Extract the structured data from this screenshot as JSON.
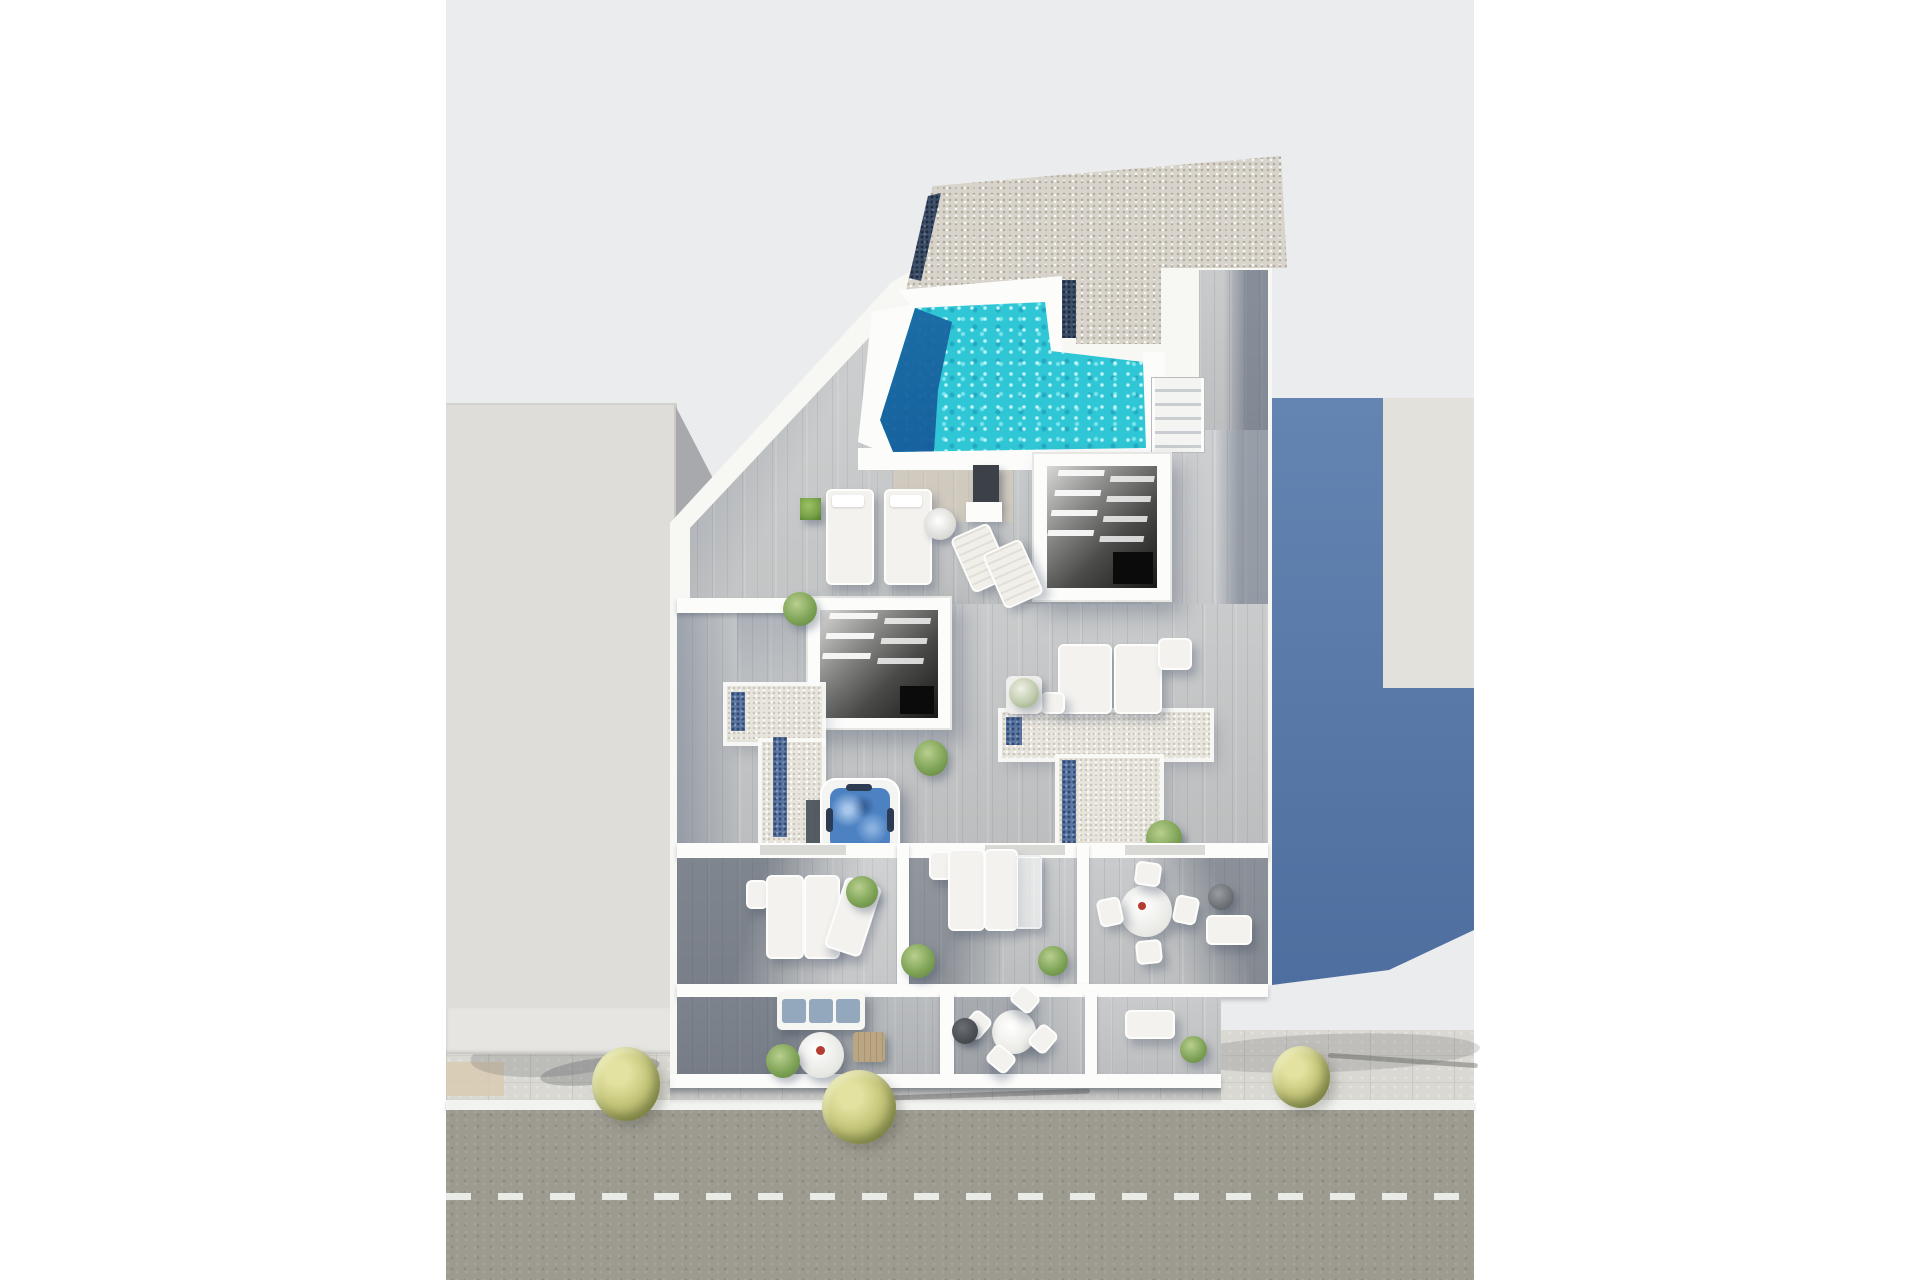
{
  "scene": {
    "title": "aerial-3d-render-roof-terrace-floor-plan",
    "objects": [
      {
        "name": "roof-gravel-deck",
        "desc": "speckled gravel flat roof with dark blue gutter strips"
      },
      {
        "name": "rooftop-pool",
        "desc": "L-shaped turquoise pool with rippled water and dark deep end"
      },
      {
        "name": "pool-stairs",
        "desc": "white staircase with railings beside pool"
      },
      {
        "name": "skylight-atrium-1",
        "desc": "open stairwell with white louver beams over dark void, east side"
      },
      {
        "name": "skylight-atrium-2",
        "desc": "open stairwell with white louver beams over dark void, center"
      },
      {
        "name": "outdoor-shower-panel",
        "desc": "dark shower panel below pool"
      },
      {
        "name": "sun-lounger",
        "desc": "white cushioned loungers on wood deck (multiple pairs)"
      },
      {
        "name": "deck-chairs-angled",
        "desc": "two folding deck chairs angled near pool"
      },
      {
        "name": "round-side-table",
        "desc": "round table with towel on pool deck"
      },
      {
        "name": "jacuzzi",
        "desc": "square hot tub with blue water and seat cutouts"
      },
      {
        "name": "gravel-terrace-left",
        "desc": "L-shaped white gravel terrace with blue mosaic strips"
      },
      {
        "name": "gravel-terrace-right",
        "desc": "T-shaped white gravel terrace with blue mosaic strips"
      },
      {
        "name": "planter-cube",
        "desc": "green hedge planter cubes"
      },
      {
        "name": "lower-rooms",
        "desc": "three cutaway rooms with daybeds, glass table, dining set"
      },
      {
        "name": "balconies",
        "desc": "three street-side balconies with sofa, round tables, plants"
      },
      {
        "name": "neighbor-building-left",
        "desc": "plain light-gray adjacent building"
      },
      {
        "name": "neighbor-building-right",
        "desc": "adjacent building mostly covered by blue-gray cast shadow"
      },
      {
        "name": "street",
        "desc": "asphalt road with dashed white center line, paver sidewalk, three yellow-green trees"
      }
    ],
    "colors": {
      "page_bg": "#ffffff",
      "backdrop": "#ebecee",
      "wall_white": "#f7f7f4",
      "wall_bright": "#fcfcfb",
      "roof_gravel": "#d8d4cb",
      "gutter_navy": "#3e4f68",
      "pool_water": "#2fc6d5",
      "pool_deep": "#17669f",
      "wood_light": "#c6c8c9",
      "wood_mid": "#b2b7bd",
      "wood_shade": "#8e99ab",
      "terrace_gravel": "#e7e4dc",
      "mosaic_blue": "#5b77a4",
      "jacuzzi_water": "#4d82c2",
      "stairwell_dark": "#2f2f2e",
      "neighbor_light": "#deddda",
      "neighbor_face": "#e6e5e1",
      "neighbor_shadow_tri": "#a7a9ad",
      "right_roof_lit": "#e2e1dc",
      "right_shadow_top": "#6484b2",
      "right_shadow_bottom": "#4e6e9f",
      "road": "#9d9b90",
      "sidewalk": "#d9d8d2",
      "curb": "#f2f3f0",
      "dash": "#edefeb",
      "paver_tan": "#d9cbb0",
      "tree_light": "#e3e2a0",
      "tree_mid": "#c6c77c",
      "tree_dark": "#8c9148",
      "sofa_cushion": "#93a7bd",
      "plant_green": "#76a047",
      "pot_dark": "#45494e",
      "ottoman_dark": "#66696d",
      "box_wood": "#bba684",
      "accent_red": "#b43c30"
    }
  }
}
